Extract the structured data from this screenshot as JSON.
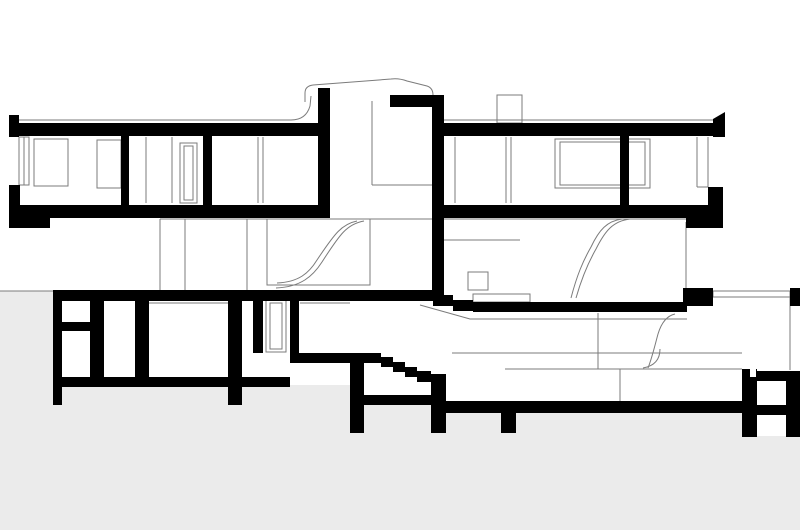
{
  "drawing": {
    "kind": "architectural-building-section",
    "visible_text": [],
    "colors": {
      "background": "#ffffff",
      "ink": "#000000",
      "thin_line": "#7b7b7b",
      "ground": "#ebebeb"
    }
  }
}
